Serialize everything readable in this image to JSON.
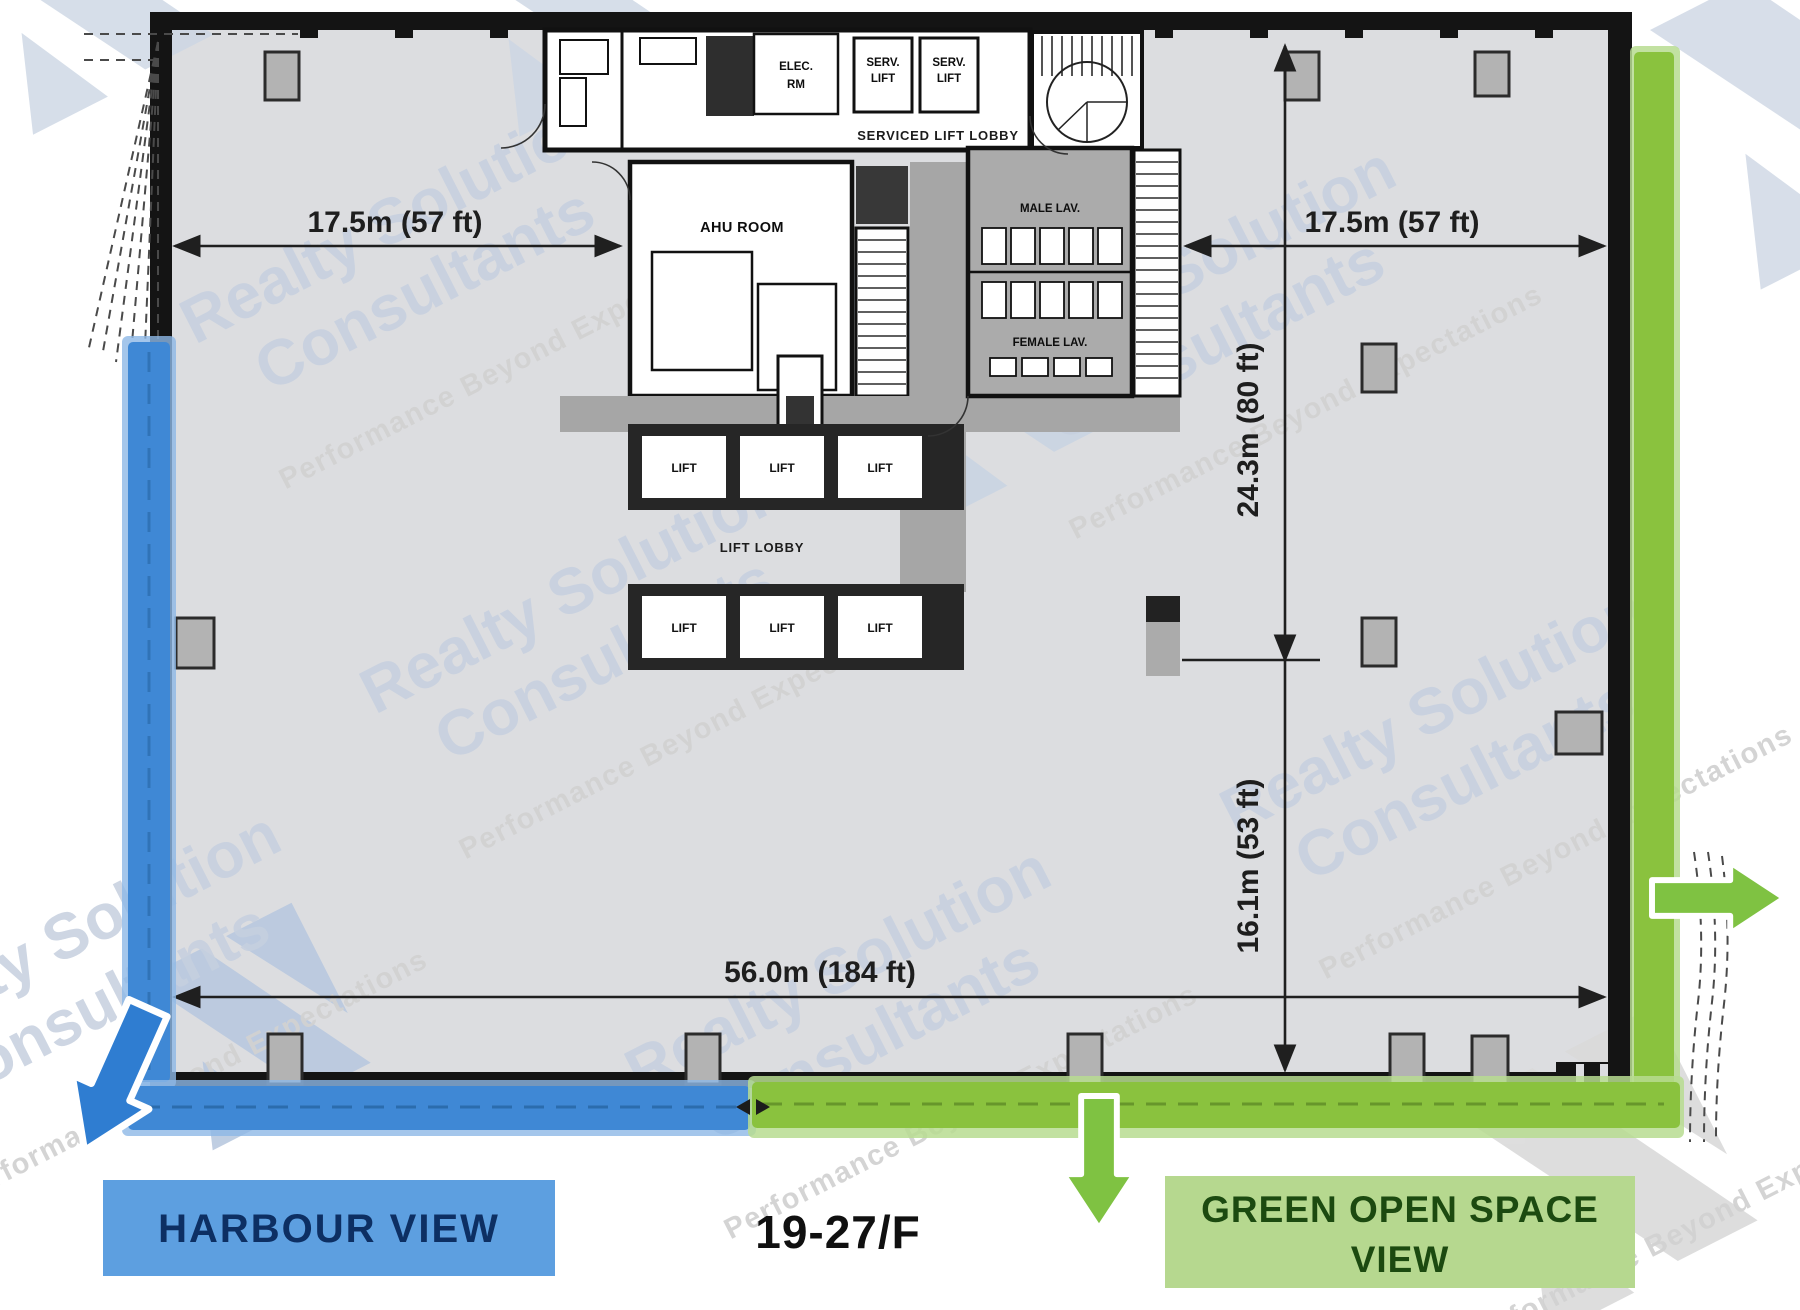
{
  "document": {
    "type": "office-floor-plan",
    "floor_label": "19-27/F"
  },
  "watermark": {
    "brand_line1": "Realty Solution",
    "brand_line2": "Consultants",
    "tagline": "Performance Beyond Expectations"
  },
  "dimensions": {
    "west_half_width": "17.5m (57 ft)",
    "east_half_width": "17.5m (57 ft)",
    "core_depth": "24.3m (80 ft)",
    "south_depth": "16.1m (53 ft)",
    "total_frontage": "56.0m (184 ft)"
  },
  "core_labels": {
    "elec_room_line1": "ELEC.",
    "elec_room_line2": "RM",
    "serv_lift_line1": "SERV.",
    "serv_lift_line2": "LIFT",
    "serviced_lift_lobby": "SERVICED LIFT LOBBY",
    "ahu_room": "AHU ROOM",
    "male_lav": "MALE LAV.",
    "female_lav": "FEMALE LAV.",
    "lift": "LIFT",
    "lift_lobby": "LIFT LOBBY"
  },
  "views": {
    "harbour": {
      "label": "HARBOUR VIEW",
      "band_color": "#3f88d5",
      "box_color": "#5d9fe0",
      "text_color": "#0d2f63",
      "arrow_color": "#2f7dd1"
    },
    "green_open_space": {
      "label_line1": "GREEN OPEN SPACE",
      "label_line2": "VIEW",
      "band_color": "#8ac23e",
      "box_color": "#b6d88f",
      "text_color": "#1c4a10",
      "arrow_color": "#7fc242"
    }
  }
}
